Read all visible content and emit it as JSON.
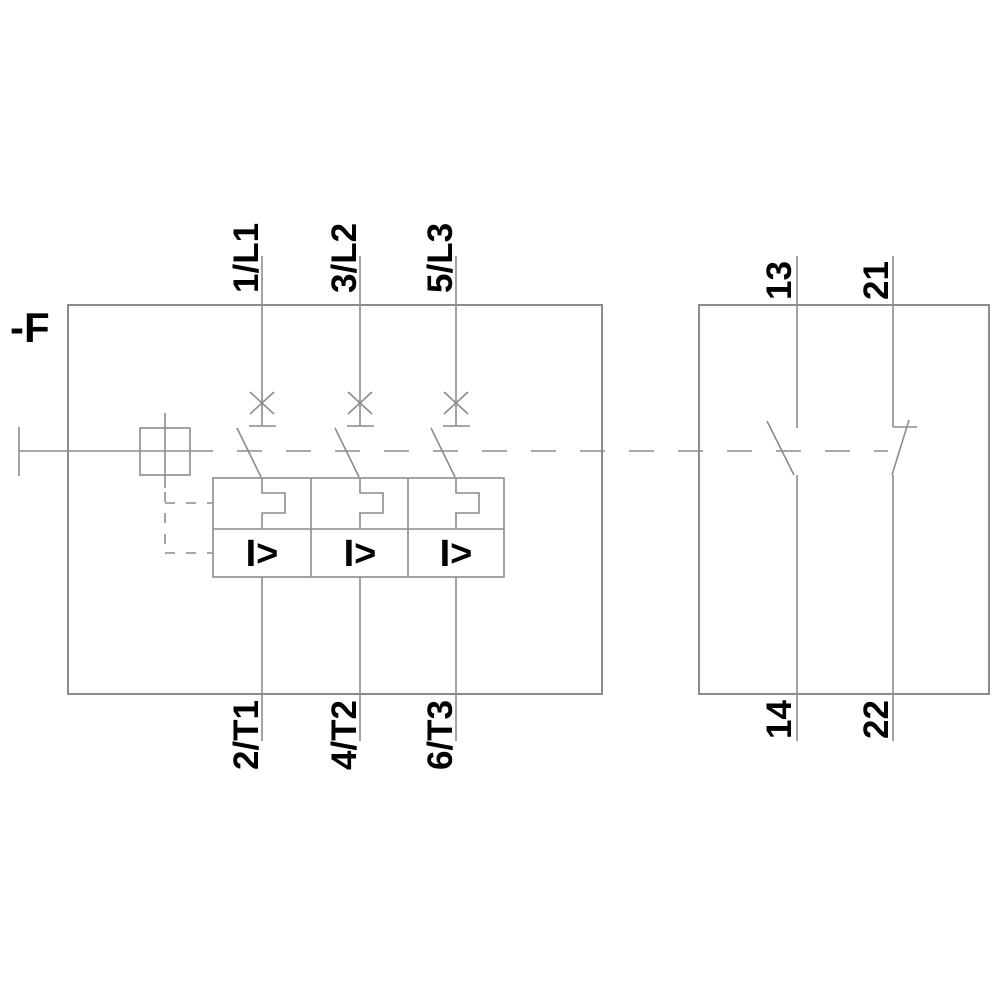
{
  "diagram": {
    "device_label": "-F",
    "main_breaker": {
      "poles": [
        {
          "top_terminal": "1/L1",
          "bottom_terminal": "2/T1"
        },
        {
          "top_terminal": "3/L2",
          "bottom_terminal": "4/T2"
        },
        {
          "top_terminal": "5/L3",
          "bottom_terminal": "6/T3"
        }
      ],
      "overcurrent_release_symbol": "I>",
      "thermal_release_icon": "thermal-overload-release",
      "trip_icon": "breaker-trip-cross"
    },
    "auxiliary_switch": {
      "no_contact": {
        "top_terminal": "13",
        "bottom_terminal": "14"
      },
      "nc_contact": {
        "top_terminal": "21",
        "bottom_terminal": "22"
      }
    },
    "colors": {
      "background": "#FFFFFF",
      "line": "#8C8C8C",
      "text": "#000000"
    }
  }
}
